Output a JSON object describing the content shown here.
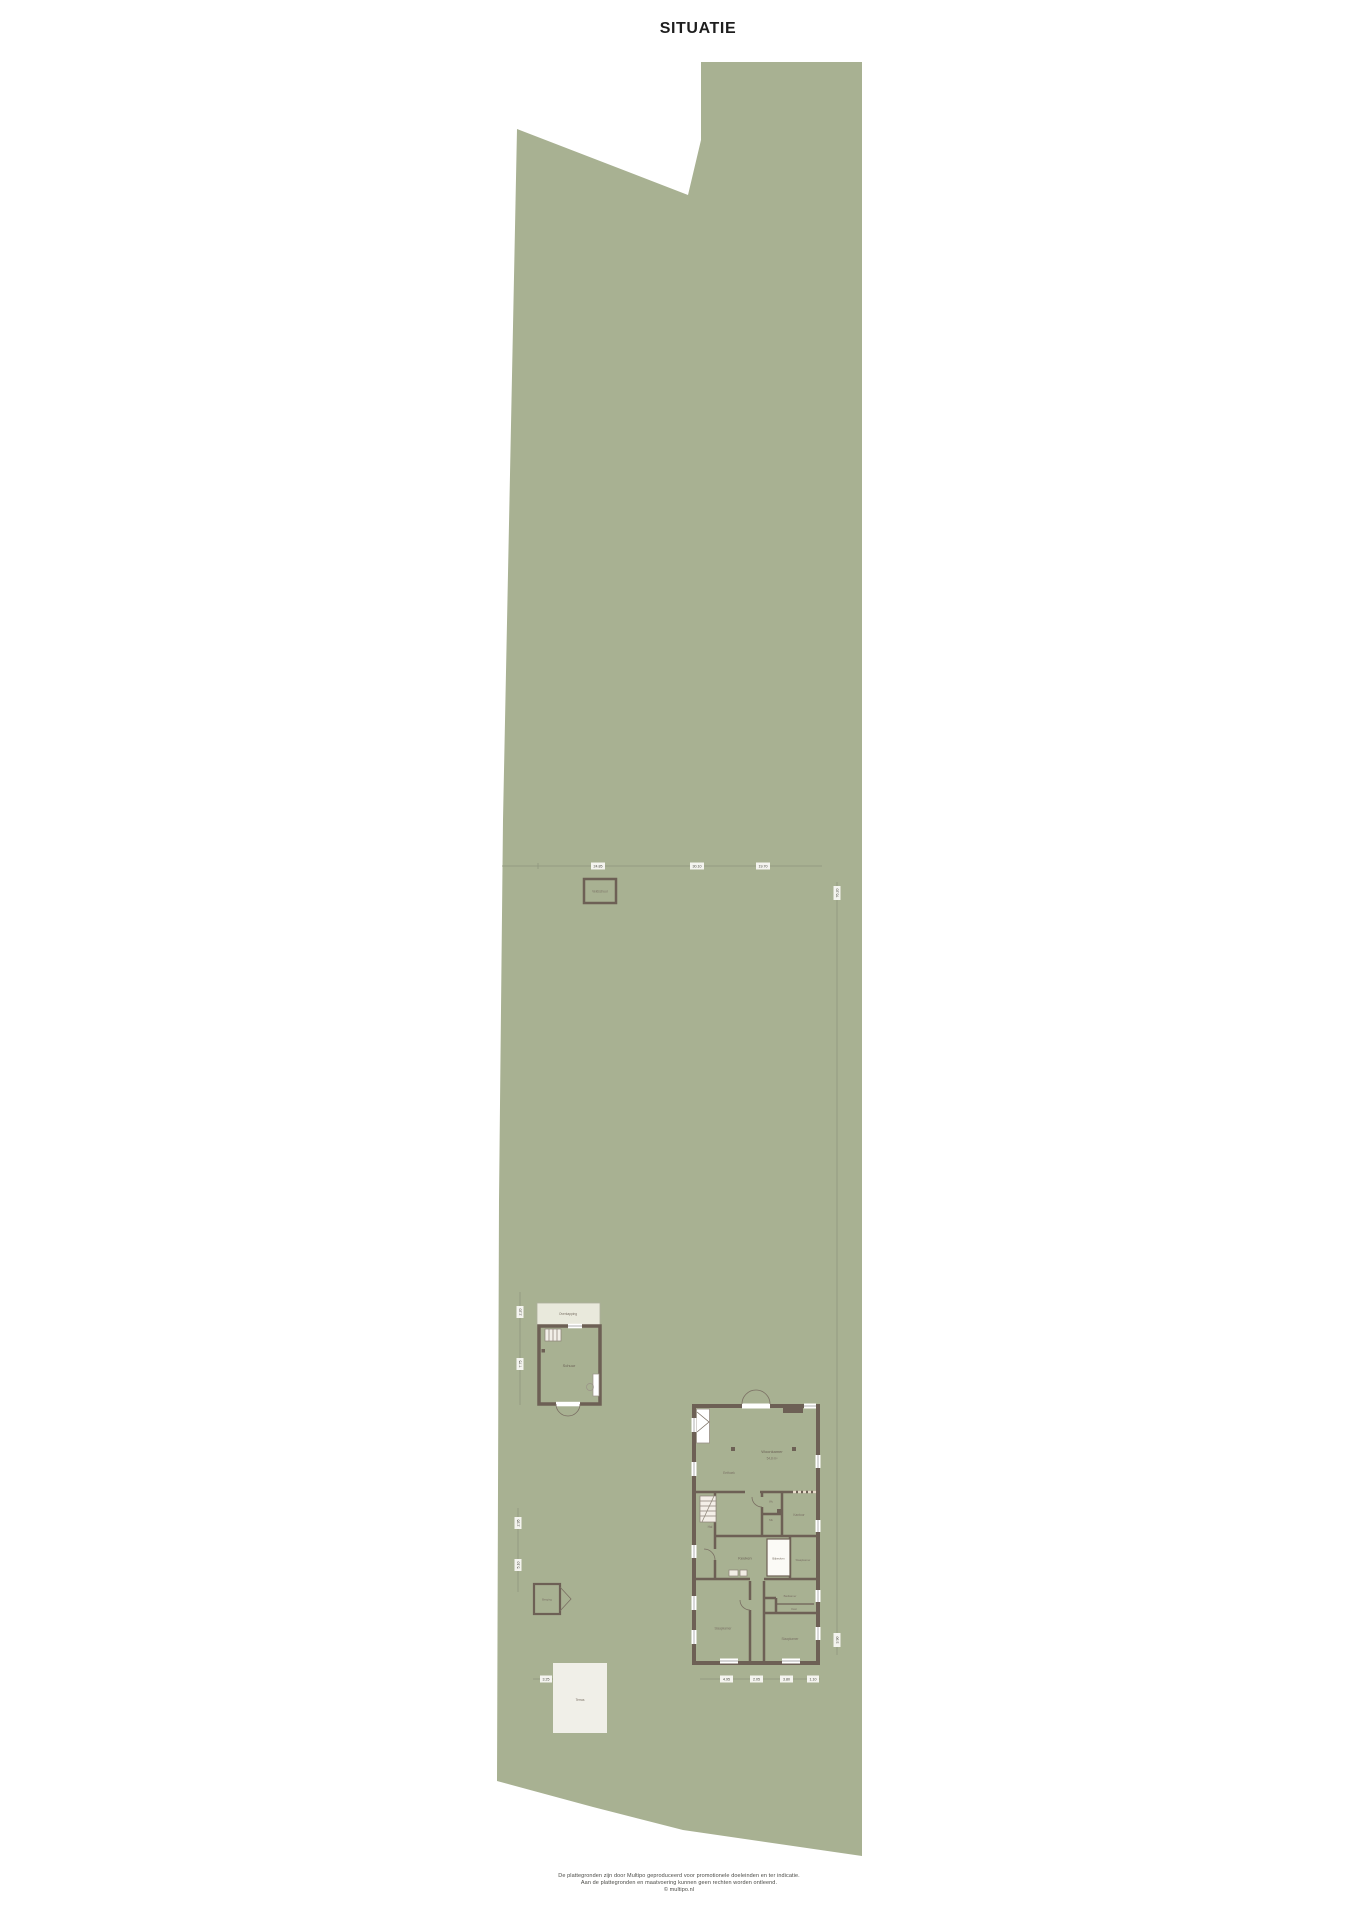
{
  "title": "SITUATIE",
  "colors": {
    "parcel_green": "#a8b192",
    "room_beige": "#e7dbca",
    "wall_brown": "#6d6055",
    "barn_white": "#f6f5f0",
    "terrace_white": "#f0efe8"
  },
  "buildings": {
    "field_barn": {
      "label": "Veldschuur"
    },
    "outbuilding": {
      "veranda": "Overkapping",
      "room": "Schuur"
    },
    "shed": {
      "label": "Berging"
    },
    "terrace": {
      "label": "Terras"
    },
    "house": {
      "woonkamer": "Woonkamer",
      "woonkamer_area": "54,8 m²",
      "eethoek": "Eethoek",
      "hal": "Hal",
      "wc": "Wc",
      "mk": "Mk",
      "kantoor": "Kantoor",
      "keuken": "Keuken",
      "bijkeuken": "Bijkeuken",
      "slaapkamer_1": "Slaapkamer",
      "slaapkamer_2": "Slaapkamer",
      "slaapkamer_3": "Slaapkamer",
      "badkamer": "Badkamer",
      "kast": "Kast"
    }
  },
  "dimensions": {
    "h1a": "24.85",
    "h1b": "30.10",
    "h1c": "19.70",
    "v1a": "76.20",
    "v1b": "3.90",
    "v2a": "2.20",
    "v2b": "7.75",
    "v3a": "2.95",
    "v3b": "5.10",
    "h2a": "3.25",
    "h3a": "4.95",
    "h3b": "2.05",
    "h3c": "3.80",
    "h3d": "1.10"
  },
  "footer": {
    "line1": "De plattegronden zijn door Multipo geproduceerd voor promotionele doeleinden en ter indicatie.",
    "line2": "Aan de plattegronden en maatvoering kunnen geen rechten worden ontleend.",
    "line3": "© multipo.nl"
  }
}
